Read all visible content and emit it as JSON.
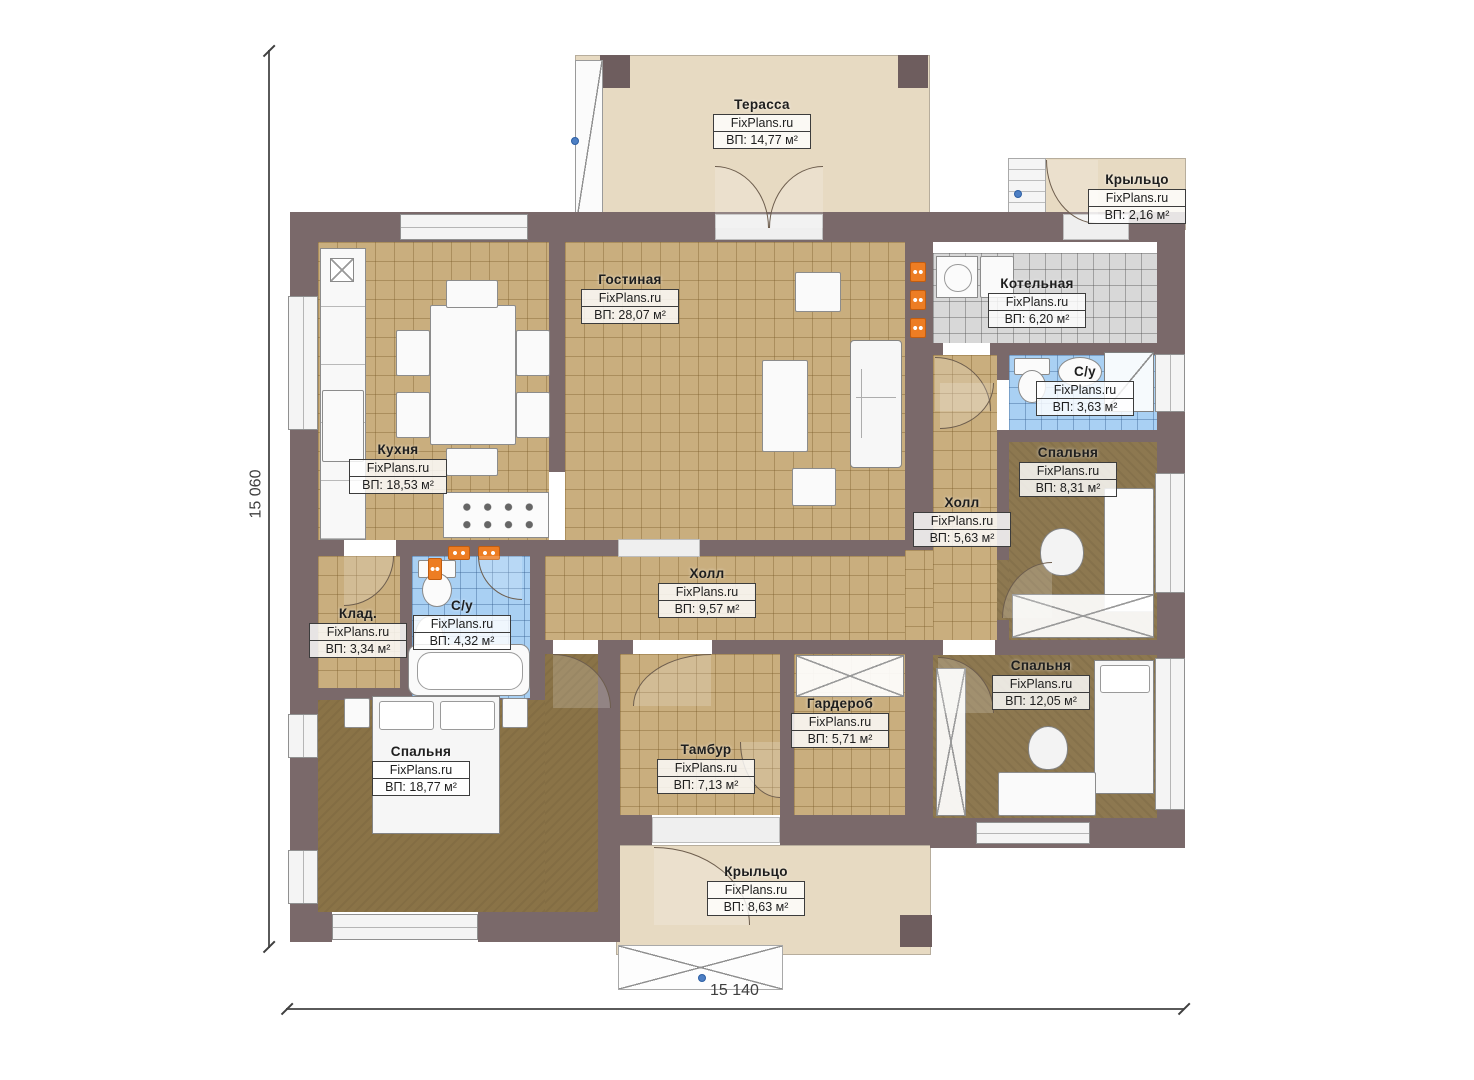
{
  "watermark": "FixPlans.ru",
  "dimensions": {
    "height_label": "15 060",
    "width_label": "15 140"
  },
  "rooms": [
    {
      "id": "terrace",
      "name": "Терасса",
      "brand": "FixPlans.ru",
      "area": "ВП: 14,77 м²"
    },
    {
      "id": "porch-top",
      "name": "Крыльцо",
      "brand": "FixPlans.ru",
      "area": "ВП: 2,16 м²"
    },
    {
      "id": "living-room",
      "name": "Гостиная",
      "brand": "FixPlans.ru",
      "area": "ВП: 28,07 м²"
    },
    {
      "id": "boiler-room",
      "name": "Котельная",
      "brand": "FixPlans.ru",
      "area": "ВП: 6,20 м²"
    },
    {
      "id": "bathroom-right",
      "name": "С/у",
      "brand": "FixPlans.ru",
      "area": "ВП: 3,63 м²"
    },
    {
      "id": "kitchen",
      "name": "Кухня",
      "brand": "FixPlans.ru",
      "area": "ВП: 18,53 м²"
    },
    {
      "id": "bedroom-right",
      "name": "Спальня",
      "brand": "FixPlans.ru",
      "area": "ВП: 8,31 м²"
    },
    {
      "id": "hall-small",
      "name": "Холл",
      "brand": "FixPlans.ru",
      "area": "ВП: 5,63 м²"
    },
    {
      "id": "storage",
      "name": "Клад.",
      "brand": "FixPlans.ru",
      "area": "ВП: 3,34 м²"
    },
    {
      "id": "bathroom-left",
      "name": "С/у",
      "brand": "FixPlans.ru",
      "area": "ВП: 4,32 м²"
    },
    {
      "id": "hall-main",
      "name": "Холл",
      "brand": "FixPlans.ru",
      "area": "ВП: 9,57 м²"
    },
    {
      "id": "wardrobe",
      "name": "Гардероб",
      "brand": "FixPlans.ru",
      "area": "ВП: 5,71 м²"
    },
    {
      "id": "bedroom-se",
      "name": "Спальня",
      "brand": "FixPlans.ru",
      "area": "ВП: 12,05 м²"
    },
    {
      "id": "bedroom-sw",
      "name": "Спальня",
      "brand": "FixPlans.ru",
      "area": "ВП: 18,77 м²"
    },
    {
      "id": "vestibule",
      "name": "Тамбур",
      "brand": "FixPlans.ru",
      "area": "ВП: 7,13 м²"
    },
    {
      "id": "porch-bottom",
      "name": "Крыльцо",
      "brand": "FixPlans.ru",
      "area": "ВП: 8,63 м²"
    }
  ],
  "colors": {
    "wall": "#7a696a",
    "outdoor": "#e7dac2",
    "floor_tan": "#c9ae7e",
    "floor_dark": "#8a7347",
    "carpet": "#8d7850",
    "tile_blue": "#a9d0f3",
    "tile_grey": "#d8d8d8",
    "pillar": "#6e5d5e",
    "radiator": "#ed7d23",
    "marker": "#4d7fc4"
  }
}
